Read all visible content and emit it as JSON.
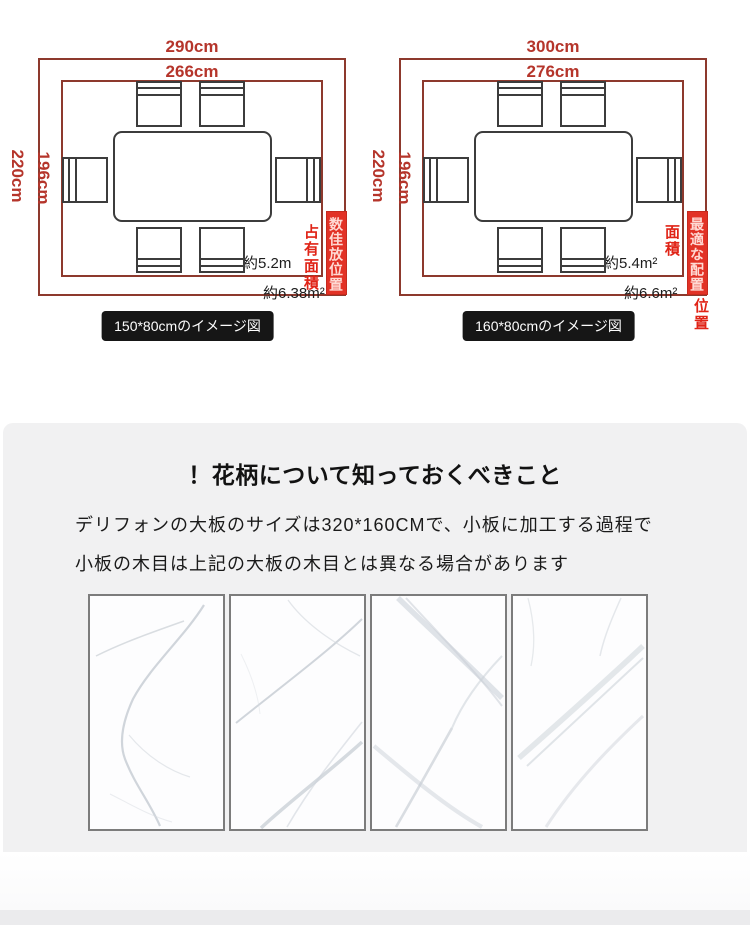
{
  "diagrams": [
    {
      "outer_width": "290cm",
      "inner_width": "266cm",
      "outer_height": "220cm",
      "inner_height": "196cm",
      "table_area": "約5.2m",
      "layout_area": "約6.38m²",
      "area_label": "占有面積",
      "banner": "数佳放位置",
      "banner_below": "",
      "caption": "150*80cmのイメージ図"
    },
    {
      "outer_width": "300cm",
      "inner_width": "276cm",
      "outer_height": "220cm",
      "inner_height": "196cm",
      "table_area": "約5.4m²",
      "layout_area": "約6.6m²",
      "area_label": "面積",
      "banner": "最適な配置",
      "banner_below": "位置",
      "caption": "160*80cmのイメージ図"
    }
  ],
  "info": {
    "title": "！花柄について知っておくべきこと",
    "line1": "デリフォンの大板のサイズは320*160CMで、小板に加工する過程で",
    "line2": "小板の木目は上記の大板の木目とは異なる場合があります"
  },
  "colors": {
    "dimension_red": "#b5352b",
    "boundary_red": "#8d392d",
    "accent_red": "#e02417",
    "banner_bg": "#e23226",
    "caption_bg": "#161616",
    "panel_gray": "#f1f1f2"
  }
}
